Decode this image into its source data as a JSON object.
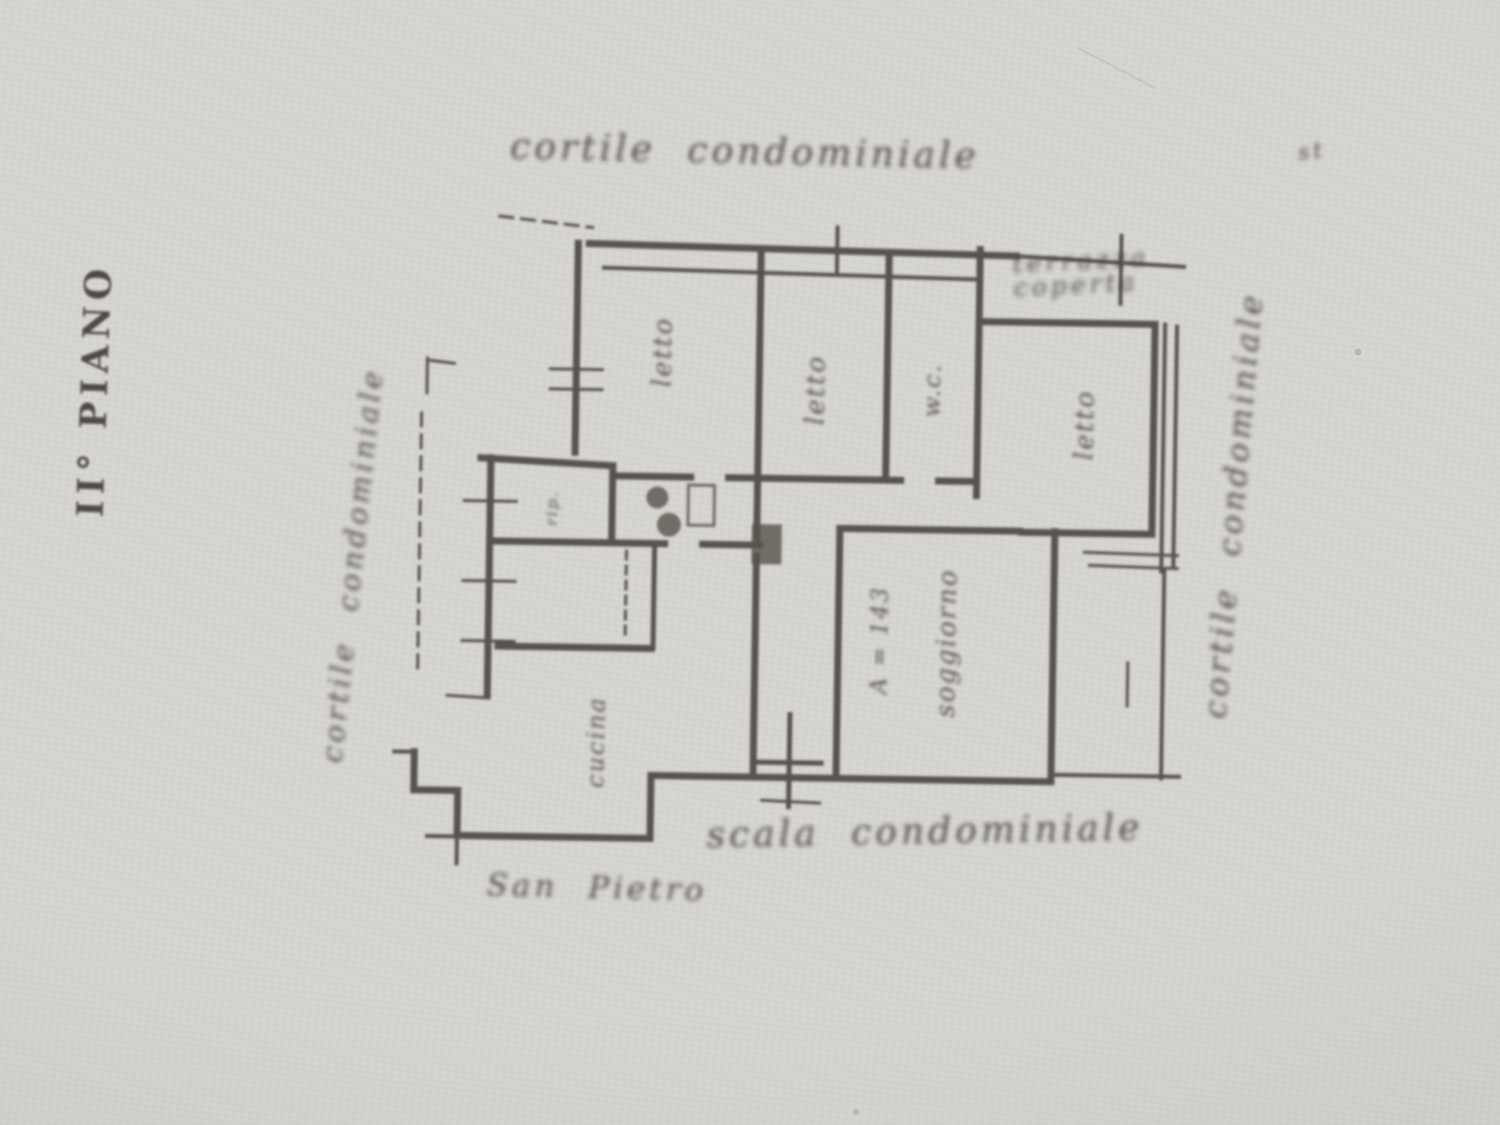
{
  "colors": {
    "paper": "#d5d4d1",
    "paper_edge": "#c7c6c3",
    "ink": "#413b36"
  },
  "floor_label": "II° PIANO",
  "annotations": {
    "top": "cortile condominiale",
    "left": "cortile condominiale",
    "right": "cortile condominiale",
    "bottom": "scala condominiale",
    "street": "San Pietro",
    "terrace": "terrazza coperta",
    "corner_mark": "st"
  },
  "rooms": {
    "bedroom1": "letto",
    "bedroom2": "letto",
    "wc": "w.c.",
    "bedroom3": "letto",
    "closet": "rip.",
    "kitchen": "cucina",
    "living": "soggiorno",
    "area_note": "A = 143"
  }
}
